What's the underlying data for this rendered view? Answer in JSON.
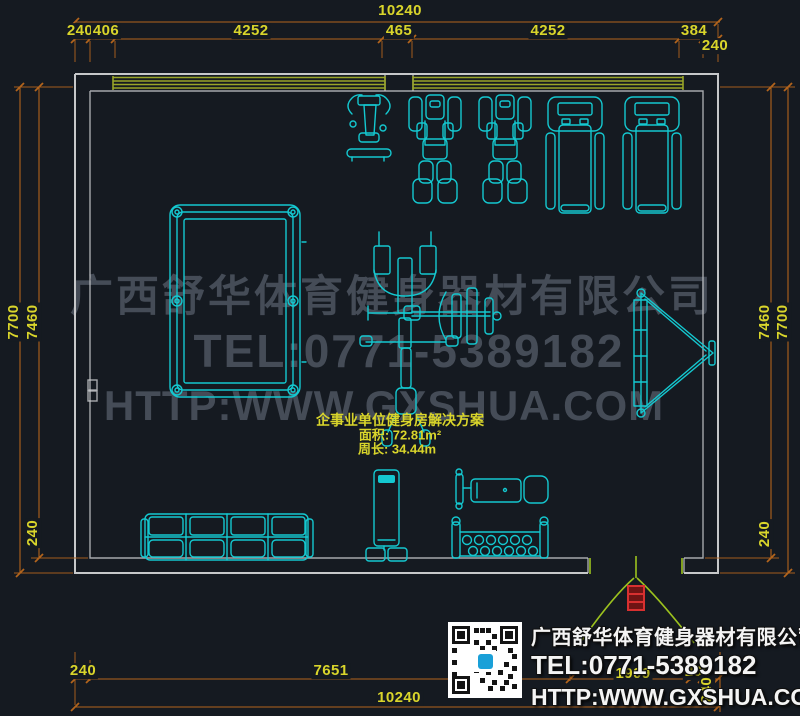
{
  "colors": {
    "background": "#151a21",
    "equipment": "#14c8d0",
    "dimension-line": "#b2641d",
    "dimension-text": "#d9d52b",
    "wall": "#c6c8ca",
    "window": "#99a528",
    "door": "#9cc21e",
    "door-marker": "#d83030",
    "watermark": "#454c57",
    "info-text": "#f4f4f4",
    "qr-logo": "#1aa0d8"
  },
  "dimensions": {
    "top": {
      "total": "10240",
      "segments": [
        "240",
        "406",
        "4252",
        "465",
        "4252",
        "384",
        "240"
      ]
    },
    "left": {
      "outer": "7700",
      "inner": "7460",
      "bottom": "240"
    },
    "right": {
      "inner": "7460",
      "outer": "7700",
      "bottom": "240"
    },
    "bottom": {
      "segments": [
        "240",
        "7651",
        "1909",
        "200"
      ],
      "wall": "240",
      "total": "10240"
    }
  },
  "plan_labels": {
    "title": "企事业单位健身房解决方案",
    "area": "面积: 72.81m²",
    "perimeter": "周长: 34.44m"
  },
  "watermark": {
    "line1": "广西舒华体育健身器材有限公司",
    "line2": "TEL:0771-5389182",
    "line3": "HTTP:WWW.GXSHUA.COM"
  },
  "info_panel": {
    "company": "广西舒华体育健身器材有限公司",
    "tel": "TEL:0771-5389182",
    "url": "HTTP:WWW.GXSHUA.COM"
  },
  "equipment": {
    "top_row": [
      "exercise-bike",
      "strength-machine",
      "strength-machine",
      "treadmill",
      "treadmill"
    ],
    "left": "pool-table",
    "center": "multi-station-gym",
    "right": "incline-sit-up-board",
    "bottom": [
      "four-seat-sofa",
      "water-dispenser",
      "weight-bench",
      "dumbbell-rack"
    ]
  }
}
